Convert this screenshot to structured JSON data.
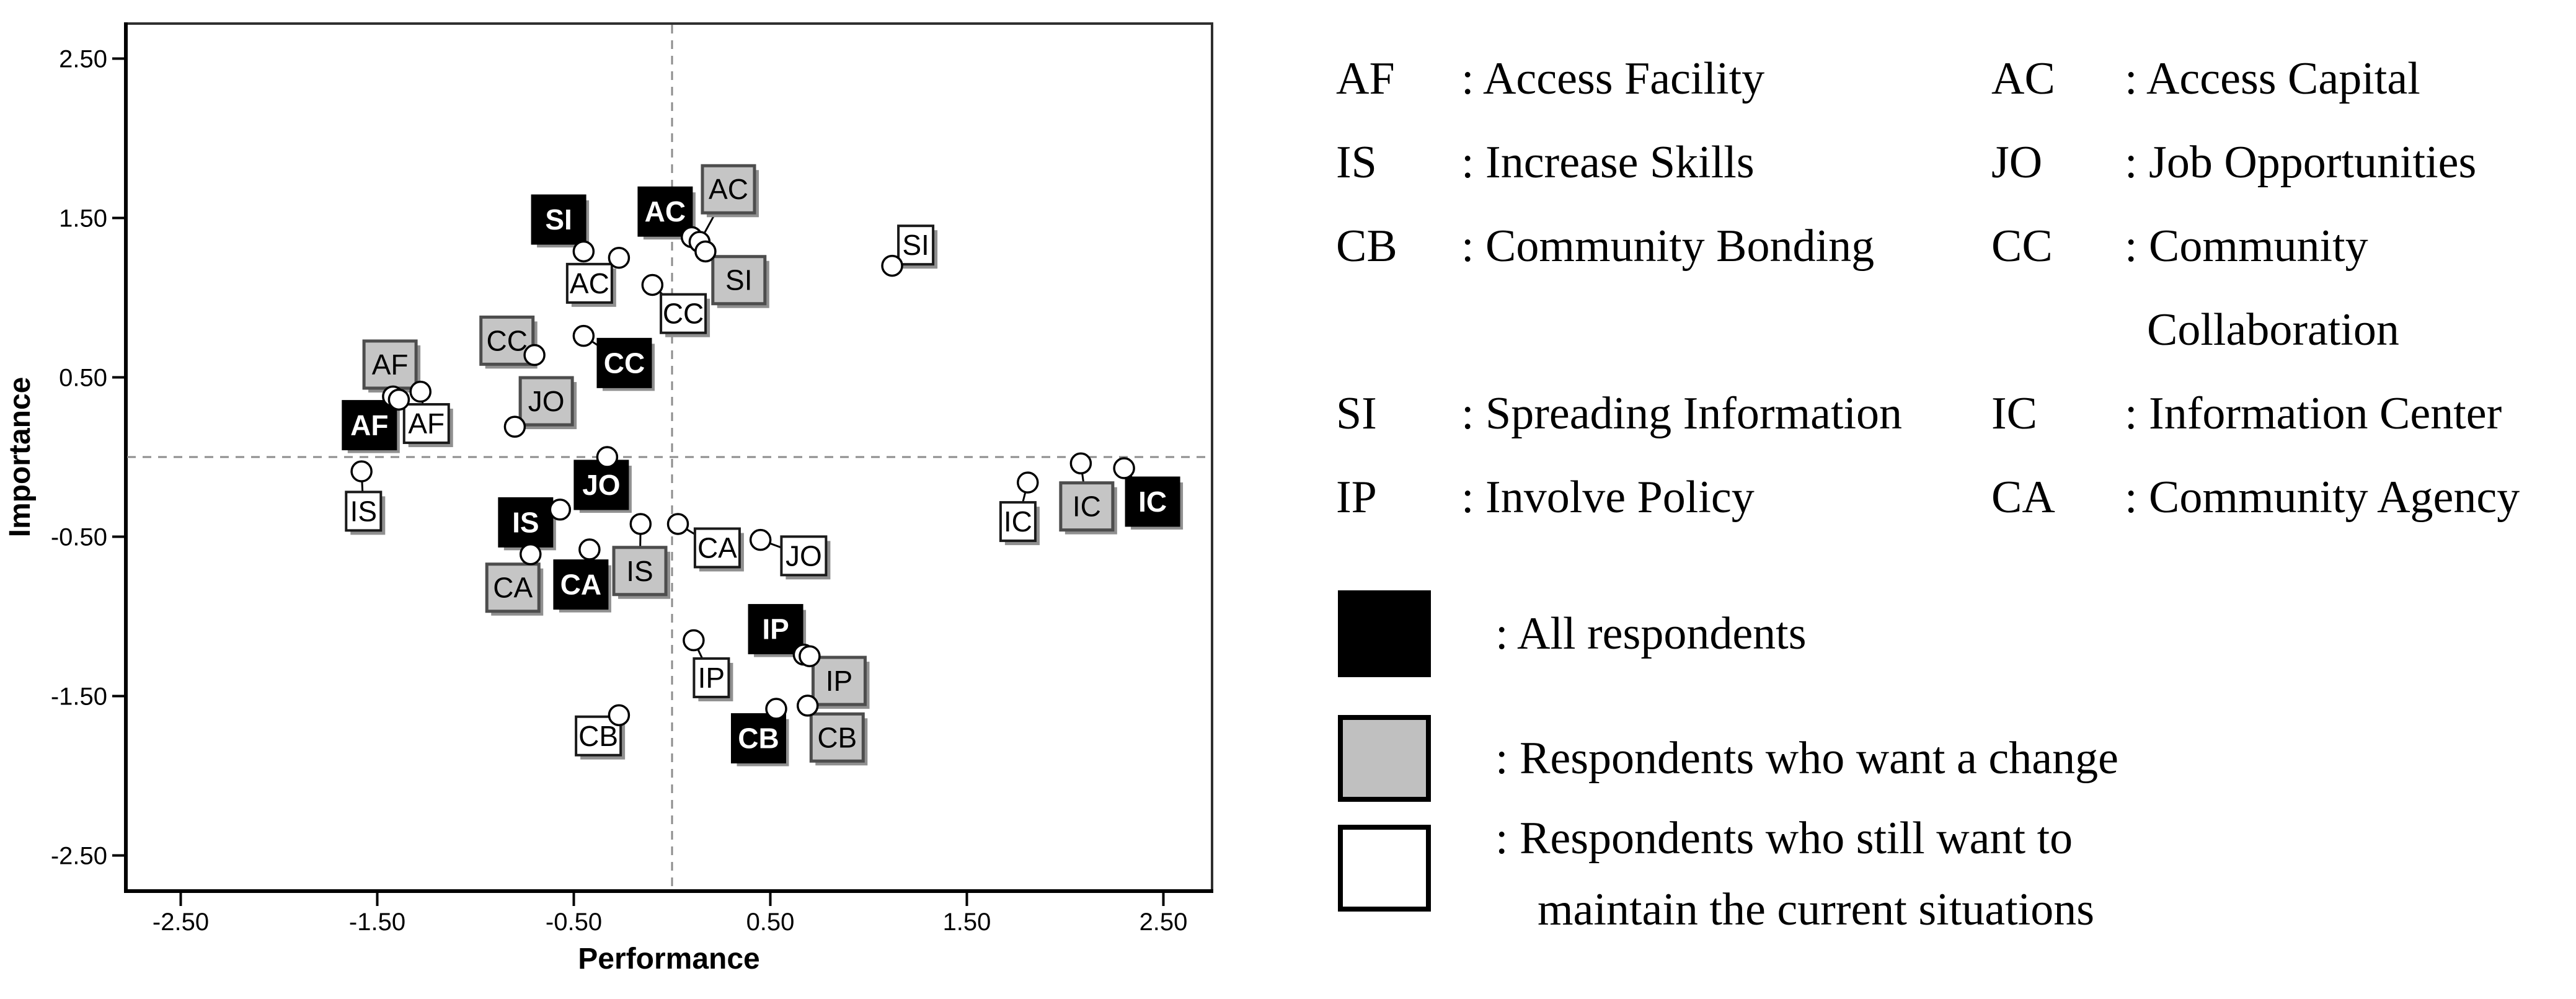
{
  "chart_data": {
    "type": "scatter",
    "title": "Importance-Performance grid of community program aspects",
    "xlabel": "Performance",
    "ylabel": "Importance",
    "xlim": [
      -2.75,
      2.75
    ],
    "ylim": [
      -2.75,
      2.75
    ],
    "xticks": [
      -2.5,
      -1.5,
      -0.5,
      0.5,
      1.5,
      2.5
    ],
    "yticks": [
      2.5,
      1.5,
      0.5,
      -0.5,
      -1.5,
      -2.5
    ],
    "grid": false,
    "reference_lines": {
      "x": 0,
      "y": 0
    },
    "marker_styles": {
      "black": {
        "fill": "#000000",
        "border": "#000000",
        "text": "#ffffff",
        "bold": true
      },
      "gray": {
        "fill": "#c5c5c5",
        "border": "#4d4d4d",
        "text": "#000000",
        "bold": false
      },
      "white": {
        "fill": "#ffffff",
        "border": "#1a1a1a",
        "text": "#000000",
        "bold": false
      }
    },
    "shadow_color": "#909090",
    "series": [
      {
        "name": "All respondents",
        "marker": "black",
        "points": [
          {
            "code": "AF",
            "x": -1.42,
            "y": 0.38,
            "label_x": -1.54,
            "label_y": 0.2
          },
          {
            "code": "AC",
            "x": 0.1,
            "y": 1.38,
            "label_x": -0.035,
            "label_y": 1.54
          },
          {
            "code": "IS",
            "x": -0.57,
            "y": -0.33,
            "label_x": -0.745,
            "label_y": -0.41
          },
          {
            "code": "JO",
            "x": -0.33,
            "y": 0.0,
            "label_x": -0.36,
            "label_y": -0.175
          },
          {
            "code": "CB",
            "x": 0.53,
            "y": -1.58,
            "label_x": 0.44,
            "label_y": -1.765
          },
          {
            "code": "CC",
            "x": -0.45,
            "y": 0.76,
            "label_x": -0.243,
            "label_y": 0.59
          },
          {
            "code": "SI",
            "x": -0.45,
            "y": 1.29,
            "label_x": -0.577,
            "label_y": 1.49
          },
          {
            "code": "IC",
            "x": 2.3,
            "y": -0.07,
            "label_x": 2.445,
            "label_y": -0.28
          },
          {
            "code": "IP",
            "x": 0.67,
            "y": -1.24,
            "label_x": 0.527,
            "label_y": -1.08
          },
          {
            "code": "CA",
            "x": -0.42,
            "y": -0.58,
            "label_x": -0.464,
            "label_y": -0.8
          }
        ]
      },
      {
        "name": "Respondents who want a change",
        "marker": "gray",
        "points": [
          {
            "code": "AF",
            "x": -1.39,
            "y": 0.36,
            "label_x": -1.435,
            "label_y": 0.58
          },
          {
            "code": "AC",
            "x": 0.14,
            "y": 1.35,
            "label_x": 0.287,
            "label_y": 1.68
          },
          {
            "code": "IS",
            "x": -0.16,
            "y": -0.42,
            "label_x": -0.164,
            "label_y": -0.715
          },
          {
            "code": "JO",
            "x": -0.8,
            "y": 0.19,
            "label_x": -0.64,
            "label_y": 0.35
          },
          {
            "code": "CB",
            "x": 0.69,
            "y": -1.56,
            "label_x": 0.84,
            "label_y": -1.76
          },
          {
            "code": "CC",
            "x": -0.7,
            "y": 0.64,
            "label_x": -0.84,
            "label_y": 0.73
          },
          {
            "code": "SI",
            "x": 0.17,
            "y": 1.29,
            "label_x": 0.34,
            "label_y": 1.11
          },
          {
            "code": "IC",
            "x": 2.08,
            "y": -0.04,
            "label_x": 2.11,
            "label_y": -0.31
          },
          {
            "code": "IP",
            "x": 0.7,
            "y": -1.25,
            "label_x": 0.85,
            "label_y": -1.405
          },
          {
            "code": "CA",
            "x": -0.72,
            "y": -0.61,
            "label_x": -0.81,
            "label_y": -0.82
          }
        ]
      },
      {
        "name": "Respondents who still want to maintain the current situations",
        "marker": "white",
        "points": [
          {
            "code": "AF",
            "x": -1.28,
            "y": 0.41,
            "label_x": -1.25,
            "label_y": 0.21
          },
          {
            "code": "AC",
            "x": -0.27,
            "y": 1.25,
            "label_x": -0.42,
            "label_y": 1.09
          },
          {
            "code": "IS",
            "x": -1.58,
            "y": -0.09,
            "label_x": -1.57,
            "label_y": -0.34
          },
          {
            "code": "JO",
            "x": 0.45,
            "y": -0.52,
            "label_x": 0.67,
            "label_y": -0.62
          },
          {
            "code": "CB",
            "x": -0.27,
            "y": -1.62,
            "label_x": -0.375,
            "label_y": -1.75
          },
          {
            "code": "CC",
            "x": -0.1,
            "y": 1.08,
            "label_x": 0.057,
            "label_y": 0.9
          },
          {
            "code": "SI",
            "x": 1.12,
            "y": 1.2,
            "label_x": 1.24,
            "label_y": 1.33
          },
          {
            "code": "IC",
            "x": 1.81,
            "y": -0.16,
            "label_x": 1.76,
            "label_y": -0.405
          },
          {
            "code": "IP",
            "x": 0.11,
            "y": -1.15,
            "label_x": 0.2,
            "label_y": -1.385
          },
          {
            "code": "CA",
            "x": 0.03,
            "y": -0.42,
            "label_x": 0.23,
            "label_y": -0.57
          }
        ]
      }
    ]
  },
  "legend": {
    "abbreviation_rows": [
      {
        "a1": "AF",
        "d1": ": Access Facility",
        "a2": "AC",
        "d2": ": Access Capital"
      },
      {
        "a1": "IS",
        "d1": ": Increase Skills",
        "a2": "JO",
        "d2": ": Job Opportunities"
      },
      {
        "a1": "CB",
        "d1": ": Community Bonding",
        "a2": "CC",
        "d2": ": Community"
      },
      {
        "cont2": "Collaboration"
      },
      {
        "a1": "SI",
        "d1": ": Spreading Information",
        "a2": "IC",
        "d2": ": Information Center"
      },
      {
        "a1": "IP",
        "d1": ": Involve Policy",
        "a2": "CA",
        "d2": ": Community Agency"
      }
    ],
    "key": [
      {
        "swatch": "black",
        "lines": [
          ": All respondents"
        ]
      },
      {
        "swatch": "gray",
        "lines": [
          ": Respondents who want a change"
        ]
      },
      {
        "swatch": "white",
        "lines": [
          ": Respondents who still want to",
          "maintain the current situations"
        ]
      }
    ]
  }
}
